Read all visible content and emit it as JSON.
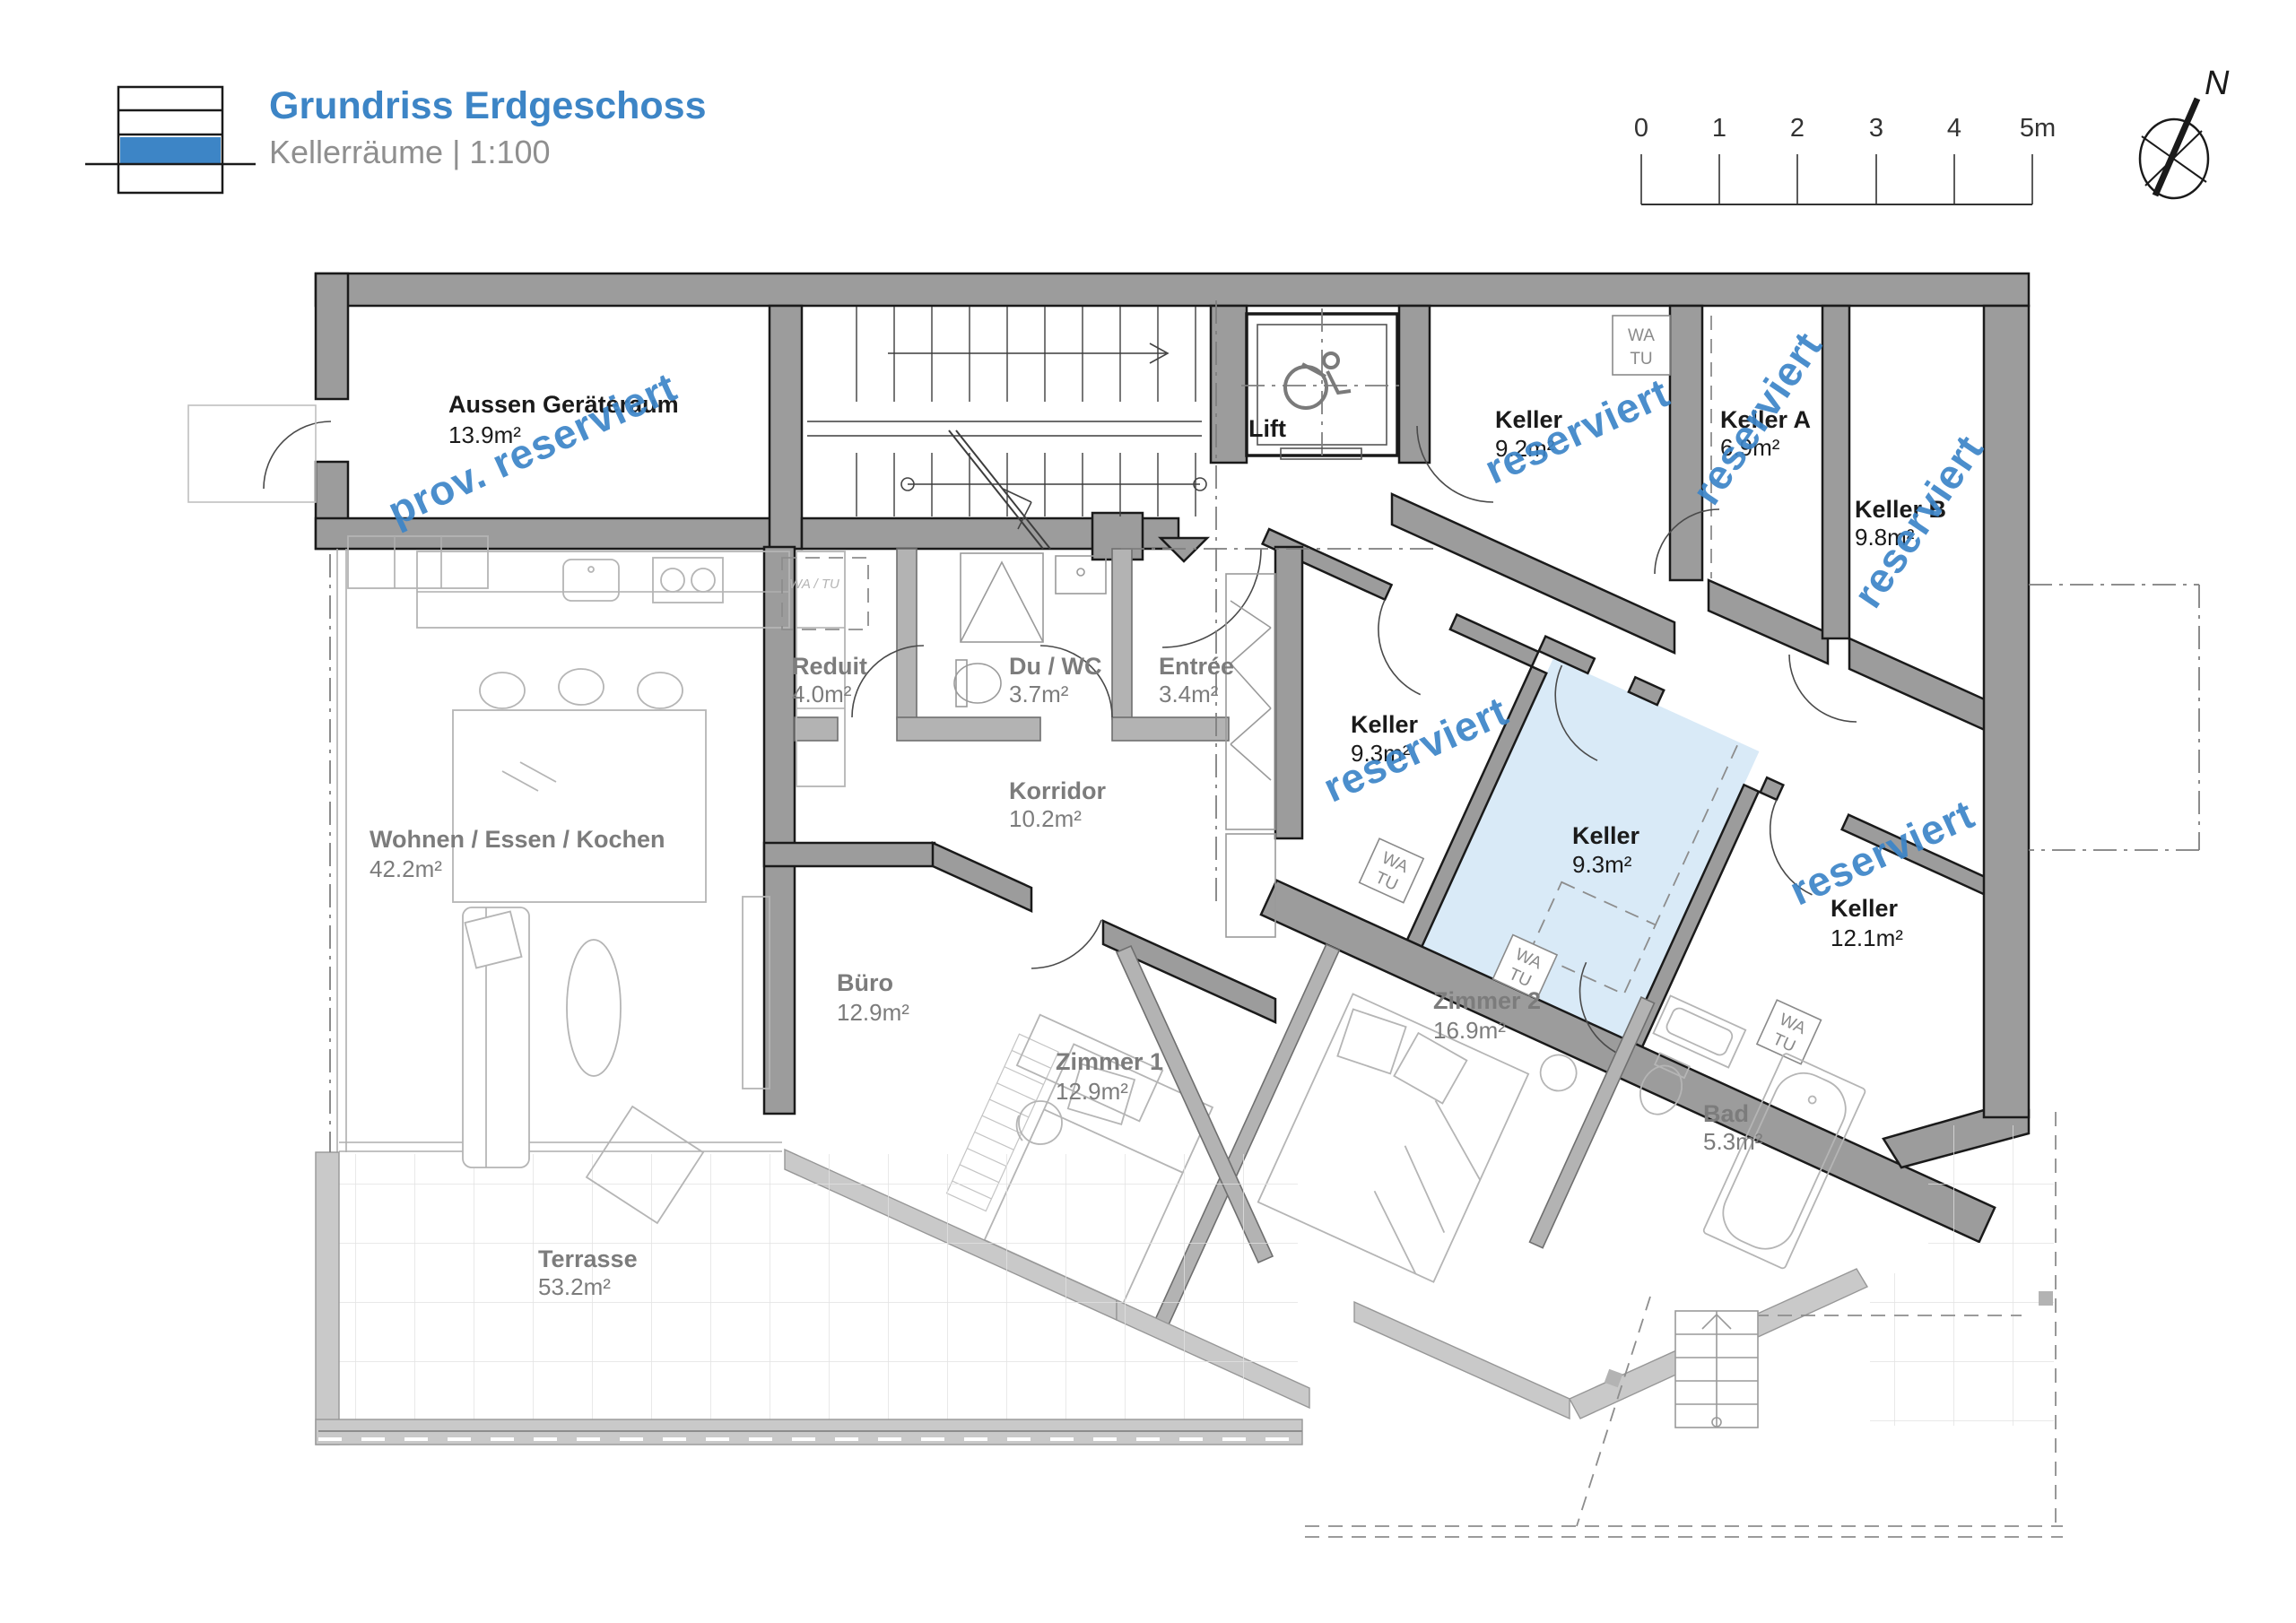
{
  "header": {
    "title": "Grundriss Erdgeschoss",
    "subtitle": "Kellerräume | 1:100"
  },
  "scalebar": {
    "ticks": [
      "0",
      "1",
      "2",
      "3",
      "4",
      "5m"
    ]
  },
  "compass": {
    "n": "N"
  },
  "watermarks": {
    "prov": "prov. reserviert",
    "res": "reserviert"
  },
  "labels": {
    "wa": "WA",
    "tu": "TU",
    "wa_tu_inline": "WA / TU"
  },
  "colors": {
    "accent_blue": "#3d85c6",
    "watermark_blue": "#3c85c8",
    "highlight_room": "#d9eaf7",
    "wall_gray": "#9c9c9c"
  },
  "rooms": [
    {
      "name": "Aussen Geräteraum",
      "area": "13.9m²",
      "zone": "keller",
      "status": "prov. reserviert"
    },
    {
      "name": "Lift",
      "area": "",
      "zone": "common"
    },
    {
      "name": "Keller",
      "area": "9.2m²",
      "zone": "keller",
      "status": "reserviert"
    },
    {
      "name": "Keller A",
      "area": "6.9m²",
      "zone": "keller",
      "status": "reserviert"
    },
    {
      "name": "Keller B",
      "area": "9.8m²",
      "zone": "keller",
      "status": "reserviert"
    },
    {
      "name": "Keller",
      "area": "9.3m²",
      "zone": "keller",
      "status": "reserviert"
    },
    {
      "name": "Keller",
      "area": "9.3m²",
      "zone": "keller",
      "status": "highlighted"
    },
    {
      "name": "Keller",
      "area": "12.1m²",
      "zone": "keller",
      "status": "reserviert"
    },
    {
      "name": "Reduit",
      "area": "4.0m²",
      "zone": "apartment"
    },
    {
      "name": "Du / WC",
      "area": "3.7m²",
      "zone": "apartment"
    },
    {
      "name": "Entrée",
      "area": "3.4m²",
      "zone": "apartment"
    },
    {
      "name": "Korridor",
      "area": "10.2m²",
      "zone": "apartment"
    },
    {
      "name": "Wohnen / Essen / Kochen",
      "area": "42.2m²",
      "zone": "apartment"
    },
    {
      "name": "Büro",
      "area": "12.9m²",
      "zone": "apartment"
    },
    {
      "name": "Zimmer 1",
      "area": "12.9m²",
      "zone": "apartment"
    },
    {
      "name": "Zimmer 2",
      "area": "16.9m²",
      "zone": "apartment"
    },
    {
      "name": "Bad",
      "area": "5.3m²",
      "zone": "apartment"
    },
    {
      "name": "Terrasse",
      "area": "53.2m²",
      "zone": "outdoor"
    }
  ]
}
